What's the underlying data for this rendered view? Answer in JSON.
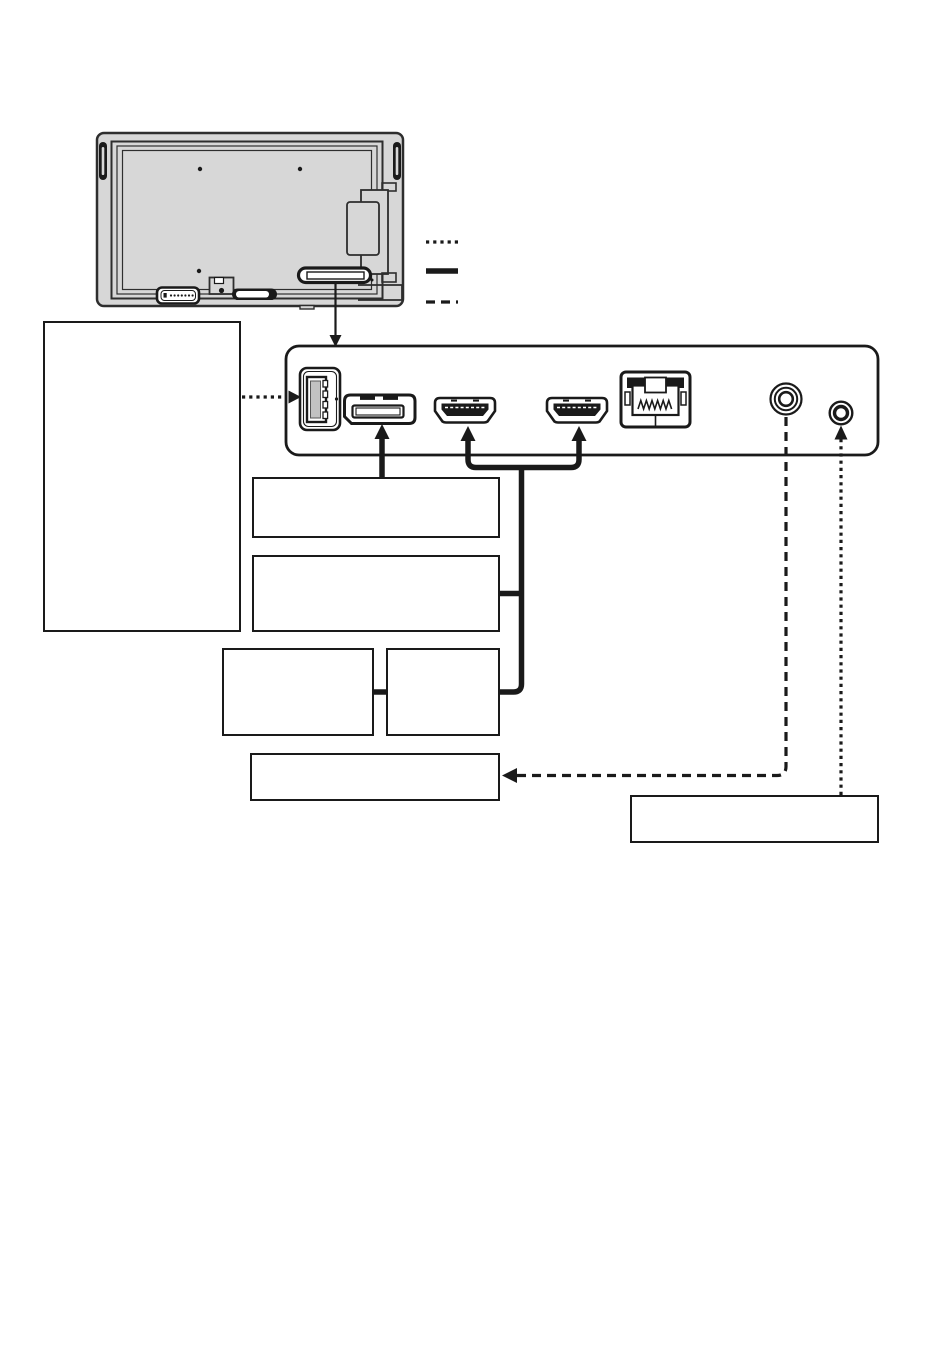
{
  "page": {
    "background": "#ffffff",
    "ink": "#1a1a1a",
    "monitor_body_fill": "#d7d7d7",
    "monitor_line": "#2e2e2e"
  },
  "monitor": {
    "name": "display-rear-view",
    "highlighted_area": "bottom-terminal-compartment"
  },
  "legend": {
    "items": [
      {
        "name": "dotted-line-sample",
        "style": "dotted",
        "label": ""
      },
      {
        "name": "solid-line-sample",
        "style": "solid-thick",
        "label": ""
      },
      {
        "name": "dashed-line-sample",
        "style": "dashed",
        "label": ""
      }
    ]
  },
  "terminal_panel": {
    "name": "terminal-board",
    "ports": [
      {
        "name": "usb-port"
      },
      {
        "name": "displayport-port"
      },
      {
        "name": "hdmi-port-1"
      },
      {
        "name": "hdmi-port-2"
      },
      {
        "name": "lan-port"
      },
      {
        "name": "audio-jack-large"
      },
      {
        "name": "audio-jack-small"
      }
    ]
  },
  "callout_boxes": [
    {
      "name": "note-box-large",
      "label": ""
    },
    {
      "name": "callout-box-displayport-source",
      "label": ""
    },
    {
      "name": "callout-box-hdmi-source-main",
      "label": ""
    },
    {
      "name": "callout-box-hdmi-left",
      "label": ""
    },
    {
      "name": "callout-box-hdmi-right",
      "label": ""
    },
    {
      "name": "callout-box-audio-output",
      "label": ""
    },
    {
      "name": "callout-box-audio-input",
      "label": ""
    }
  ],
  "connections": [
    {
      "name": "panel-pointer-arrow",
      "style": "solid-thin",
      "from": "display-rear-view",
      "to": "terminal-board"
    },
    {
      "name": "usb-dotted-arrow",
      "style": "dotted",
      "from": "note-box-large",
      "to": "usb-port"
    },
    {
      "name": "displayport-cable-arrow",
      "style": "solid-thick",
      "from": "callout-box-displayport-source",
      "to": "displayport-port"
    },
    {
      "name": "hdmi-cable-manifold",
      "style": "solid-thick",
      "from": "callout-box-hdmi-source-main",
      "to": "hdmi-port-1 and hdmi-port-2"
    },
    {
      "name": "audio-out-dashed-arrow",
      "style": "dashed",
      "from": "audio-jack-large",
      "to": "callout-box-audio-output"
    },
    {
      "name": "audio-in-dotted-arrow",
      "style": "dotted",
      "from": "callout-box-audio-input",
      "to": "audio-jack-small"
    }
  ]
}
